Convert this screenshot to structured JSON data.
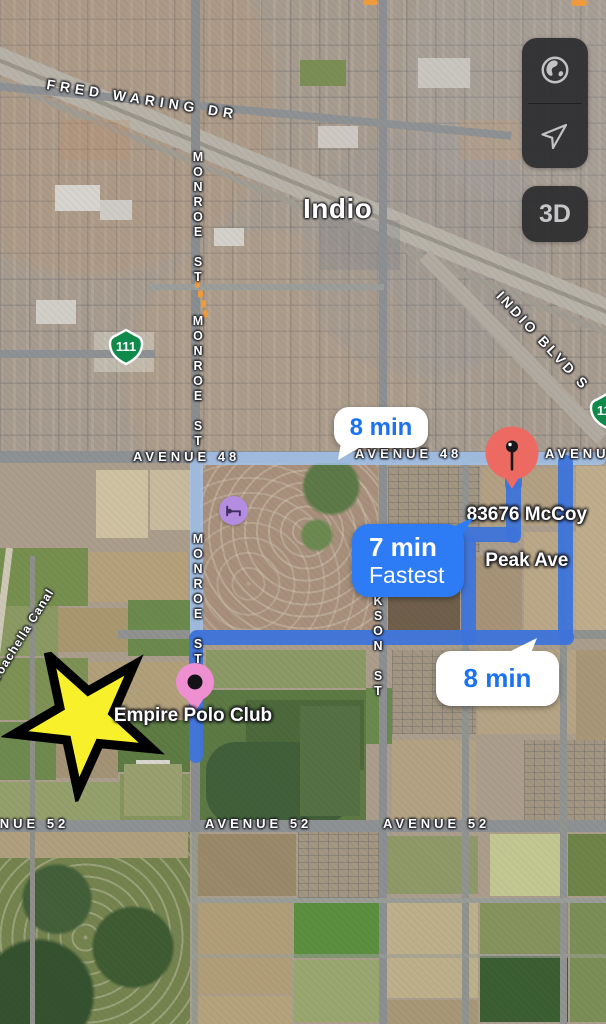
{
  "map": {
    "city_label": "Indio",
    "labels": {
      "fred_waring": "FRED WARING DR",
      "monroe_top": "MONROE ST",
      "monroe_mid": "MONROE ST",
      "monroe_bottom": "MONROE ST",
      "indio_blvd_s": "INDIO BLVD S",
      "avenue48_left": "AVENUE 48",
      "avenue48_mid": "AVENUE 48",
      "avenue48_right": "AVENUE 48",
      "jackson_st": "JACKSON ST",
      "avenue52_left": "AVENUE 52",
      "avenue52_mid": "AVENUE 52",
      "avenue52_right": "AVENUE 52",
      "coachella_canal": "Coachella Canal"
    },
    "shields": {
      "left": "111",
      "right": "111"
    }
  },
  "route": {
    "colors": {
      "selected": "#3E74DA",
      "alternate": "#A2C4EE"
    },
    "etas": {
      "top": "8 min",
      "fastest_time": "7 min",
      "fastest_tag": "Fastest",
      "bottom": "8 min"
    },
    "destination": {
      "label_line1": "83676 McCoy",
      "label_line2": "Peak Ave",
      "pin_color": "#ED6A63"
    },
    "origin": {
      "label": "Empire Polo Club",
      "pin_color": "#EE8FD2"
    }
  },
  "pois": {
    "lodging": {
      "icon": "bed-icon",
      "color": "#B48CE0"
    }
  },
  "traffic": {
    "color": "#F09A3E"
  },
  "controls": {
    "threed_label": "3D"
  },
  "annotation_star": {
    "fill": "#F8F02A",
    "outline": "#000000"
  }
}
